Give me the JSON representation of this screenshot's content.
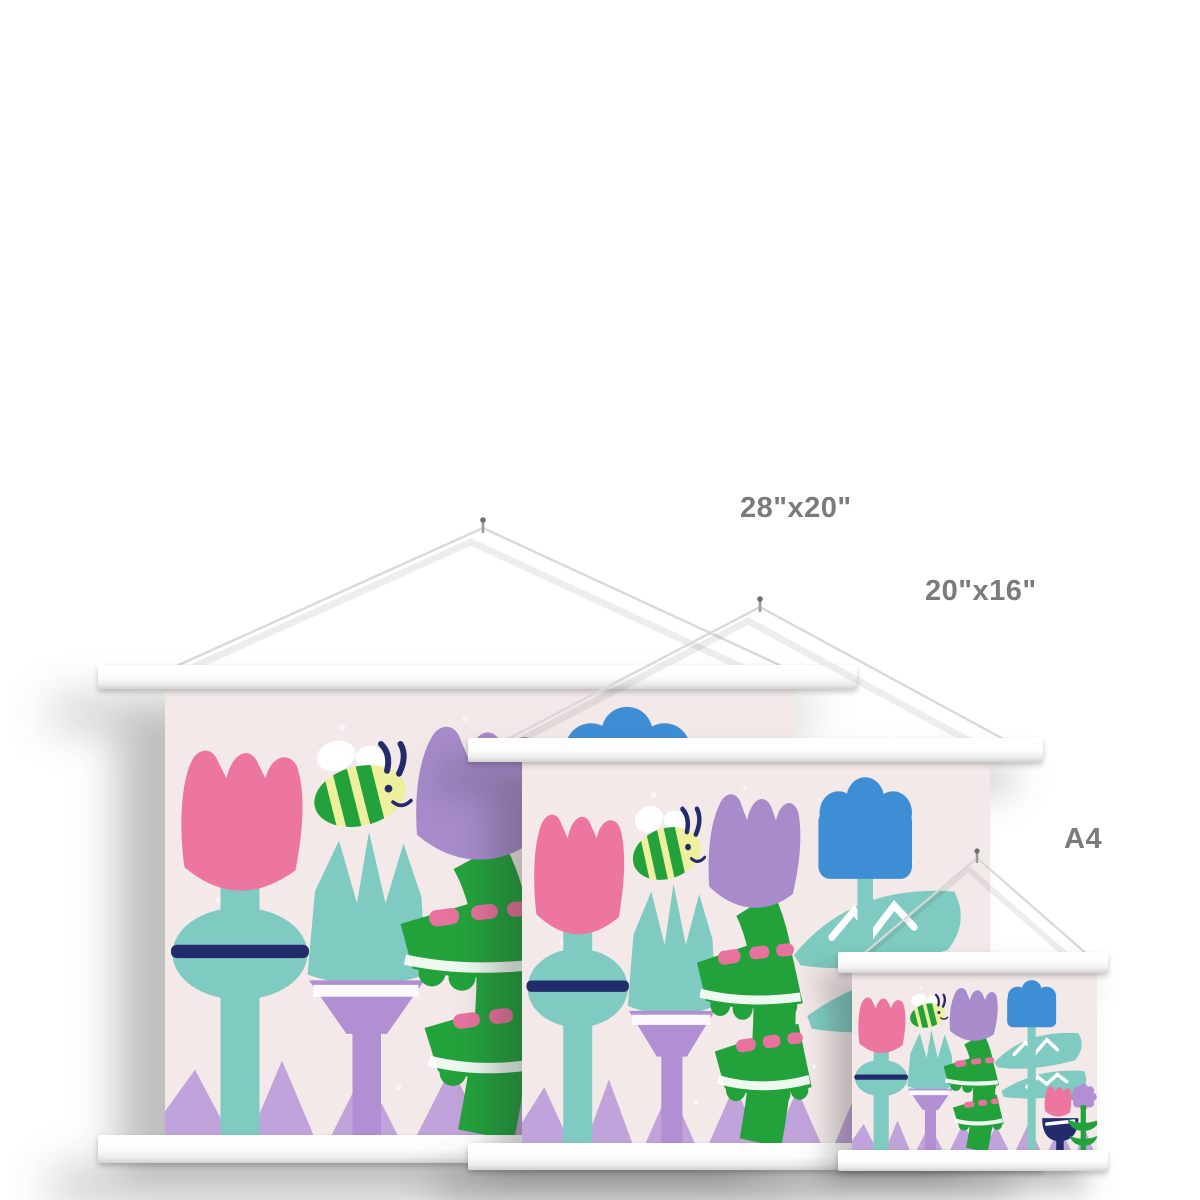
{
  "scene": {
    "type": "poster-size-comparison-mockup",
    "wall_color": "#ffffff"
  },
  "size_labels": {
    "large": "28\"x20\"",
    "medium": "20\"x16\"",
    "small": "A4"
  },
  "posters": [
    {
      "id": "large",
      "size_label": "28\"x20\"",
      "orientation": "landscape"
    },
    {
      "id": "medium",
      "size_label": "20\"x16\"",
      "orientation": "landscape"
    },
    {
      "id": "small",
      "size_label": "A4",
      "orientation": "landscape"
    }
  ],
  "hardware": {
    "bar_color": "#f5f5f5",
    "string_color": "#d9d9d9",
    "nail_color": "#8a8a8a",
    "label_text_color": "#7b7b7b"
  },
  "artwork": {
    "name": "flower-garden-illustration",
    "background": "#f4e9e9",
    "elements": [
      "pink-tulip",
      "bumble-bee",
      "teal-crown-plant",
      "purple-tulip",
      "green-leaves-with-pink-spots",
      "blue-flower",
      "teal-leaves-with-white-zigzag",
      "small-pink-tulip-navy-bulb",
      "purple-pompom-flower",
      "lilac-zigzag-border"
    ],
    "colors": {
      "pink": "#ed76a1",
      "teal": "#7fcbc1",
      "navy": "#222c6b",
      "purple": "#a78bcb",
      "lilac": "#c0a3da",
      "green": "#23a23c",
      "blue": "#3e8ed5",
      "bee_yellow": "#eff09d",
      "white": "#ffffff"
    }
  }
}
